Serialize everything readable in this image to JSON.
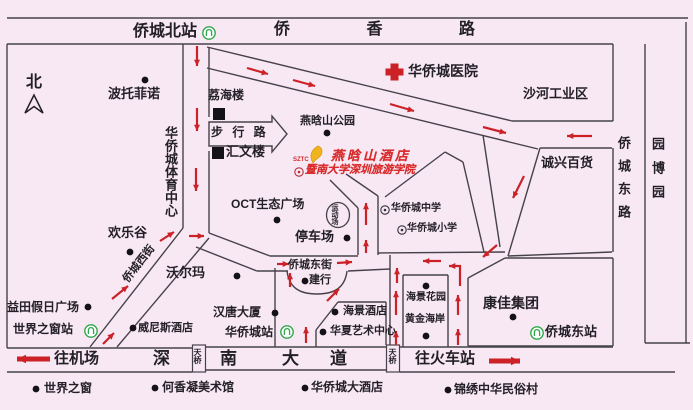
{
  "canvas": {
    "w": 693,
    "h": 410,
    "bg": "#f7e8f4"
  },
  "colors": {
    "line": "#47424a",
    "text": "#231f26",
    "red": "#cb2127",
    "green": "#2fa84c",
    "gold": "#f2b41e",
    "hotel_red": "#d92b2b"
  },
  "labels": [
    {
      "n": "qiaoxiang-road-label",
      "t": "侨 香 路",
      "x": 274,
      "y": 22,
      "fs": 16,
      "ls": 36
    },
    {
      "n": "qiaochengbei-station-label",
      "t": "侨城北站",
      "x": 133,
      "y": 24,
      "fs": 16
    },
    {
      "n": "north-label",
      "t": "北",
      "x": 26,
      "y": 75,
      "fs": 16
    },
    {
      "n": "botuofeinuo-label",
      "t": "波托菲诺",
      "x": 108,
      "y": 87,
      "fs": 13
    },
    {
      "n": "lihailou-label",
      "t": "荔海楼",
      "x": 208,
      "y": 89,
      "fs": 12
    },
    {
      "n": "pedestrian-road-label",
      "t": "步 行 路",
      "x": 211,
      "y": 126,
      "fs": 12,
      "ls": 3
    },
    {
      "n": "huiwenlou-label",
      "t": "汇文楼",
      "x": 226,
      "y": 145,
      "fs": 13
    },
    {
      "n": "yanhanshan-park-label",
      "t": "燕晗山公园",
      "x": 300,
      "y": 116,
      "fs": 11
    },
    {
      "n": "sztc-label",
      "t": "SZTC",
      "x": 293,
      "y": 157,
      "fs": 6,
      "cls": "red"
    },
    {
      "n": "hotel-name-label",
      "t": "燕晗山酒店",
      "x": 331,
      "y": 149,
      "fs": 13,
      "ls": 3,
      "cls": "red script"
    },
    {
      "n": "college-label",
      "t": "暨南大学深圳旅游学院",
      "x": 305,
      "y": 165,
      "fs": 11,
      "cls": "red script"
    },
    {
      "n": "hospital-label",
      "t": "华侨城医院",
      "x": 408,
      "y": 64,
      "fs": 14
    },
    {
      "n": "shahe-industrial-label",
      "t": "沙河工业区",
      "x": 523,
      "y": 87,
      "fs": 13
    },
    {
      "n": "chengxing-store-label",
      "t": "诚兴百货",
      "x": 541,
      "y": 156,
      "fs": 13
    },
    {
      "n": "sports-center-label",
      "t": "华侨城体育中心",
      "x": 164,
      "y": 126,
      "fs": 13,
      "v": 1
    },
    {
      "n": "qiaocheng-east-road-label",
      "t": "侨城东路",
      "x": 617,
      "y": 136,
      "fs": 13,
      "v": 1,
      "ls": 10
    },
    {
      "n": "yuanboyuan-label",
      "t": "园博园",
      "x": 651,
      "y": 137,
      "fs": 13,
      "v": 1,
      "ls": 11
    },
    {
      "n": "happy-valley-label",
      "t": "欢乐谷",
      "x": 108,
      "y": 226,
      "fs": 13
    },
    {
      "n": "oct-plaza-label",
      "t": "OCT生态广场",
      "x": 231,
      "y": 198,
      "fs": 12
    },
    {
      "n": "parking-label",
      "t": "停车场",
      "x": 295,
      "y": 230,
      "fs": 13
    },
    {
      "n": "walmart-label",
      "t": "沃尔玛",
      "x": 166,
      "y": 266,
      "fs": 13
    },
    {
      "n": "qiaocheng-west-street-label",
      "t": "侨城西街",
      "x": 126,
      "y": 276,
      "fs": 11,
      "rot": -52
    },
    {
      "n": "qiaocheng-east-street-label",
      "t": "侨城东街",
      "x": 288,
      "y": 260,
      "fs": 11
    },
    {
      "n": "jianhang-label",
      "t": "建行",
      "x": 309,
      "y": 275,
      "fs": 11
    },
    {
      "n": "middle-school-label",
      "t": "华侨城中学",
      "x": 391,
      "y": 204,
      "fs": 10
    },
    {
      "n": "primary-school-label",
      "t": "华侨城小学",
      "x": 407,
      "y": 224,
      "fs": 10
    },
    {
      "n": "hantang-tower-label",
      "t": "汉唐大厦",
      "x": 213,
      "y": 306,
      "fs": 12
    },
    {
      "n": "qiaocheng-station-label",
      "t": "华侨城站",
      "x": 225,
      "y": 326,
      "fs": 12
    },
    {
      "n": "venice-hotel-label",
      "t": "威尼斯酒店",
      "x": 138,
      "y": 323,
      "fs": 11
    },
    {
      "n": "yitian-plaza-label",
      "t": "益田假日广场",
      "x": 7,
      "y": 301,
      "fs": 12
    },
    {
      "n": "window-world-station-label",
      "t": "世界之窗站",
      "x": 13,
      "y": 323,
      "fs": 12
    },
    {
      "n": "haijing-hotel-label",
      "t": "海景酒店",
      "x": 343,
      "y": 306,
      "fs": 11
    },
    {
      "n": "huaxia-art-center-label",
      "t": "华夏艺术中心",
      "x": 330,
      "y": 326,
      "fs": 11
    },
    {
      "n": "haijing-garden-label",
      "t": "海景花园",
      "x": 406,
      "y": 293,
      "fs": 10
    },
    {
      "n": "golden-coast-label",
      "t": "黄金海岸",
      "x": 405,
      "y": 315,
      "fs": 10
    },
    {
      "n": "konka-group-label",
      "t": "康佳集团",
      "x": 483,
      "y": 296,
      "fs": 14
    },
    {
      "n": "qiaochengdong-station-label",
      "t": "侨城东站",
      "x": 545,
      "y": 325,
      "fs": 13
    },
    {
      "n": "to-airport-label",
      "t": "往机场",
      "x": 54,
      "y": 351,
      "fs": 15
    },
    {
      "n": "shennan-road-label-shen",
      "t": "深",
      "x": 153,
      "y": 350,
      "fs": 17
    },
    {
      "n": "shennan-road-label-nan",
      "t": "南",
      "x": 220,
      "y": 350,
      "fs": 17
    },
    {
      "n": "shennan-road-label-da",
      "t": "大",
      "x": 282,
      "y": 350,
      "fs": 17
    },
    {
      "n": "shennan-road-label-dao",
      "t": "道",
      "x": 330,
      "y": 350,
      "fs": 17
    },
    {
      "n": "footbridge-label-1",
      "t": "天桥",
      "x": 193,
      "y": 348,
      "fs": 8,
      "v": 1
    },
    {
      "n": "footbridge-label-2",
      "t": "天桥",
      "x": 388,
      "y": 348,
      "fs": 8,
      "v": 1
    },
    {
      "n": "to-railway-label",
      "t": "往火车站",
      "x": 415,
      "y": 351,
      "fs": 15
    },
    {
      "n": "window-of-world-label",
      "t": "世界之窗",
      "x": 44,
      "y": 382,
      "fs": 12
    },
    {
      "n": "hexiangning-museum-label",
      "t": "何香凝美术馆",
      "x": 162,
      "y": 381,
      "fs": 12
    },
    {
      "n": "oct-grand-hotel-label",
      "t": "华侨城大酒店",
      "x": 311,
      "y": 381,
      "fs": 12
    },
    {
      "n": "splendid-china-label",
      "t": "锦绣中华民俗村",
      "x": 454,
      "y": 383,
      "fs": 12
    },
    {
      "n": "stadium-label",
      "t": "运动场",
      "x": 331,
      "y": 204,
      "fs": 7,
      "v": 1
    }
  ],
  "dots": [
    [
      145,
      80
    ],
    [
      130,
      252
    ],
    [
      327,
      133
    ],
    [
      277,
      220
    ],
    [
      347,
      238
    ],
    [
      237,
      276
    ],
    [
      305,
      281
    ],
    [
      275,
      313
    ],
    [
      133,
      328
    ],
    [
      335,
      312
    ],
    [
      323,
      332
    ],
    [
      426,
      286
    ],
    [
      426,
      336
    ],
    [
      513,
      317
    ],
    [
      88,
      307
    ],
    [
      36,
      389
    ],
    [
      155,
      388
    ],
    [
      305,
      388
    ],
    [
      448,
      390
    ]
  ],
  "squares": [
    [
      213,
      108
    ],
    [
      212,
      147
    ]
  ],
  "metro_stations": [
    [
      209,
      33
    ],
    [
      91,
      331
    ],
    [
      287,
      332
    ],
    [
      537,
      333
    ]
  ],
  "school_icons": [
    [
      385,
      210
    ],
    [
      402,
      230
    ]
  ],
  "college_icon": [
    299,
    172
  ],
  "lines": [
    [
      7,
      18,
      688,
      18
    ],
    [
      7,
      44,
      613,
      44
    ],
    [
      7,
      44,
      7,
      348
    ],
    [
      183,
      44,
      183,
      228
    ],
    [
      209,
      48,
      209,
      117
    ],
    [
      209,
      151,
      209,
      233
    ],
    [
      207,
      47,
      512,
      121
    ],
    [
      512,
      121,
      613,
      121
    ],
    [
      207,
      68,
      538,
      149
    ],
    [
      613,
      44,
      613,
      121
    ],
    [
      613,
      148,
      613,
      252
    ],
    [
      613,
      258,
      613,
      346
    ],
    [
      645,
      44,
      645,
      343
    ],
    [
      645,
      343,
      690,
      343
    ],
    [
      686,
      22,
      686,
      343
    ],
    [
      540,
      148,
      612,
      148
    ],
    [
      540,
      148,
      508,
      256
    ],
    [
      508,
      256,
      612,
      252
    ],
    [
      483,
      135,
      500,
      247
    ],
    [
      445,
      152,
      463,
      162
    ],
    [
      463,
      162,
      484,
      252
    ],
    [
      385,
      197,
      445,
      152
    ],
    [
      330,
      180,
      358,
      208
    ],
    [
      346,
      174,
      378,
      196
    ],
    [
      358,
      208,
      358,
      255
    ],
    [
      378,
      196,
      378,
      255
    ],
    [
      209,
      233,
      270,
      256
    ],
    [
      270,
      256,
      358,
      256
    ],
    [
      378,
      253,
      505,
      252
    ],
    [
      196,
      247,
      257,
      271
    ],
    [
      257,
      271,
      288,
      271
    ],
    [
      348,
      271,
      390,
      269
    ],
    [
      390,
      255,
      390,
      347
    ],
    [
      403,
      275,
      448,
      275
    ],
    [
      403,
      275,
      403,
      347
    ],
    [
      448,
      275,
      448,
      347
    ],
    [
      468,
      278,
      468,
      346
    ],
    [
      468,
      278,
      505,
      258
    ],
    [
      505,
      258,
      613,
      258
    ],
    [
      468,
      346,
      613,
      346
    ],
    [
      275,
      268,
      275,
      347
    ],
    [
      316,
      330,
      338,
      302
    ],
    [
      338,
      302,
      386,
      302
    ],
    [
      316,
      330,
      316,
      347
    ],
    [
      386,
      302,
      386,
      345
    ],
    [
      183,
      228,
      90,
      347
    ],
    [
      209,
      238,
      117,
      347
    ],
    [
      7,
      348,
      192,
      348
    ],
    [
      7,
      372,
      192,
      372
    ],
    [
      205,
      347,
      386,
      347
    ],
    [
      205,
      370,
      386,
      370
    ],
    [
      400,
      347,
      613,
      347
    ],
    [
      400,
      372,
      675,
      372
    ]
  ],
  "arrows": [
    {
      "x1": 197,
      "y1": 46,
      "x2": 197,
      "y2": 66
    },
    {
      "x1": 197,
      "y1": 108,
      "x2": 197,
      "y2": 131
    },
    {
      "x1": 196,
      "y1": 168,
      "x2": 196,
      "y2": 191
    },
    {
      "x1": 247,
      "y1": 68,
      "x2": 268,
      "y2": 74
    },
    {
      "x1": 293,
      "y1": 80,
      "x2": 315,
      "y2": 86
    },
    {
      "x1": 390,
      "y1": 104,
      "x2": 414,
      "y2": 111
    },
    {
      "x1": 483,
      "y1": 127,
      "x2": 506,
      "y2": 133
    },
    {
      "x1": 592,
      "y1": 136,
      "x2": 567,
      "y2": 136
    },
    {
      "x1": 524,
      "y1": 176,
      "x2": 513,
      "y2": 198
    },
    {
      "x1": 497,
      "y1": 245,
      "x2": 483,
      "y2": 257
    },
    {
      "x1": 160,
      "y1": 241,
      "x2": 174,
      "y2": 232
    },
    {
      "x1": 189,
      "y1": 236,
      "x2": 204,
      "y2": 236
    },
    {
      "x1": 112,
      "y1": 299,
      "x2": 128,
      "y2": 286
    },
    {
      "x1": 103,
      "y1": 344,
      "x2": 114,
      "y2": 333
    },
    {
      "x1": 277,
      "y1": 264,
      "x2": 289,
      "y2": 264
    },
    {
      "x1": 337,
      "y1": 263,
      "x2": 352,
      "y2": 262
    },
    {
      "x1": 290,
      "y1": 287,
      "x2": 290,
      "y2": 273
    },
    {
      "x1": 327,
      "y1": 301,
      "x2": 339,
      "y2": 289
    },
    {
      "x1": 366,
      "y1": 253,
      "x2": 366,
      "y2": 240
    },
    {
      "x1": 366,
      "y1": 225,
      "x2": 366,
      "y2": 203
    },
    {
      "x1": 306,
      "y1": 343,
      "x2": 306,
      "y2": 327
    },
    {
      "x1": 441,
      "y1": 261,
      "x2": 423,
      "y2": 261
    },
    {
      "pts": [
        [
          460,
          286
        ],
        [
          460,
          266
        ],
        [
          449,
          266
        ]
      ]
    },
    {
      "x1": 397,
      "y1": 283,
      "x2": 397,
      "y2": 268
    },
    {
      "x1": 396,
      "y1": 315,
      "x2": 396,
      "y2": 291
    },
    {
      "x1": 396,
      "y1": 345,
      "x2": 396,
      "y2": 331
    },
    {
      "x1": 458,
      "y1": 315,
      "x2": 458,
      "y2": 295
    },
    {
      "x1": 458,
      "y1": 345,
      "x2": 458,
      "y2": 329
    },
    {
      "x1": 50,
      "y1": 359,
      "x2": 17,
      "y2": 359,
      "w": 5,
      "hs": 10
    },
    {
      "x1": 489,
      "y1": 361,
      "x2": 520,
      "y2": 361,
      "w": 5,
      "hs": 10
    }
  ],
  "shapes": {
    "hospital_cross": "M391,64 H398 V69 H403 V75 H398 V80 H391 V75 H386 V69 H391 Z",
    "north_arrow": "M34,95 L25,113 L34,106.5 L43,113 Z",
    "hotel_logo": "M318,146 C311,150 309,156 313,163 C316,158 321,158 322,152 C322.5,148.8 320,147 318,146 Z",
    "pedestrian_block_arrow": "M209,122 H272 V116 L287,134 L272,152 V146 H209 Z",
    "jianhang_arc": "M287,271 C289,288 300,294 317,294 C334,294 345,288 347,271",
    "footbridge_boxes": [
      [
        192.5,
        345,
        13,
        27
      ],
      [
        386.5,
        345,
        13,
        27
      ]
    ],
    "stadium_circle": [
      338,
      215,
      11.5,
      12.5
    ]
  }
}
